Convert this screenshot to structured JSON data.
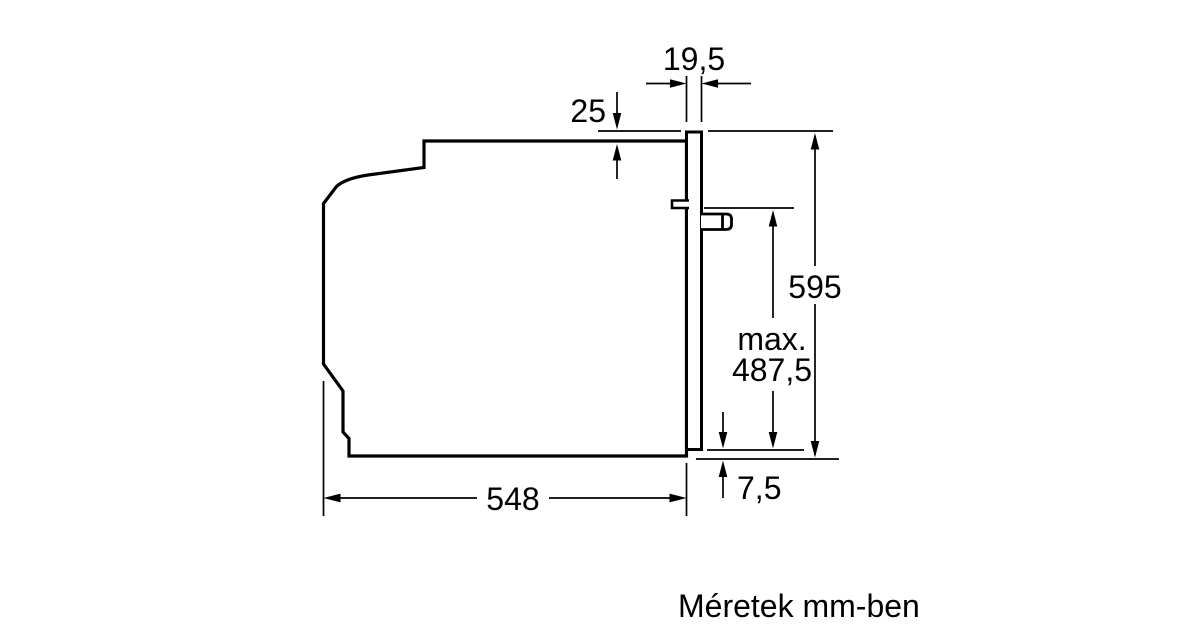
{
  "diagram": {
    "caption": "Méretek mm-ben",
    "unit": "mm",
    "dimension_labels": {
      "door_thickness": "19,5",
      "top_clearance": "25",
      "height": "595",
      "max_line1": "max.",
      "max_line2": "487,5",
      "bottom_clearance": "7,5",
      "depth": "548"
    },
    "colors": {
      "line": "#000000",
      "background": "#ffffff"
    }
  }
}
